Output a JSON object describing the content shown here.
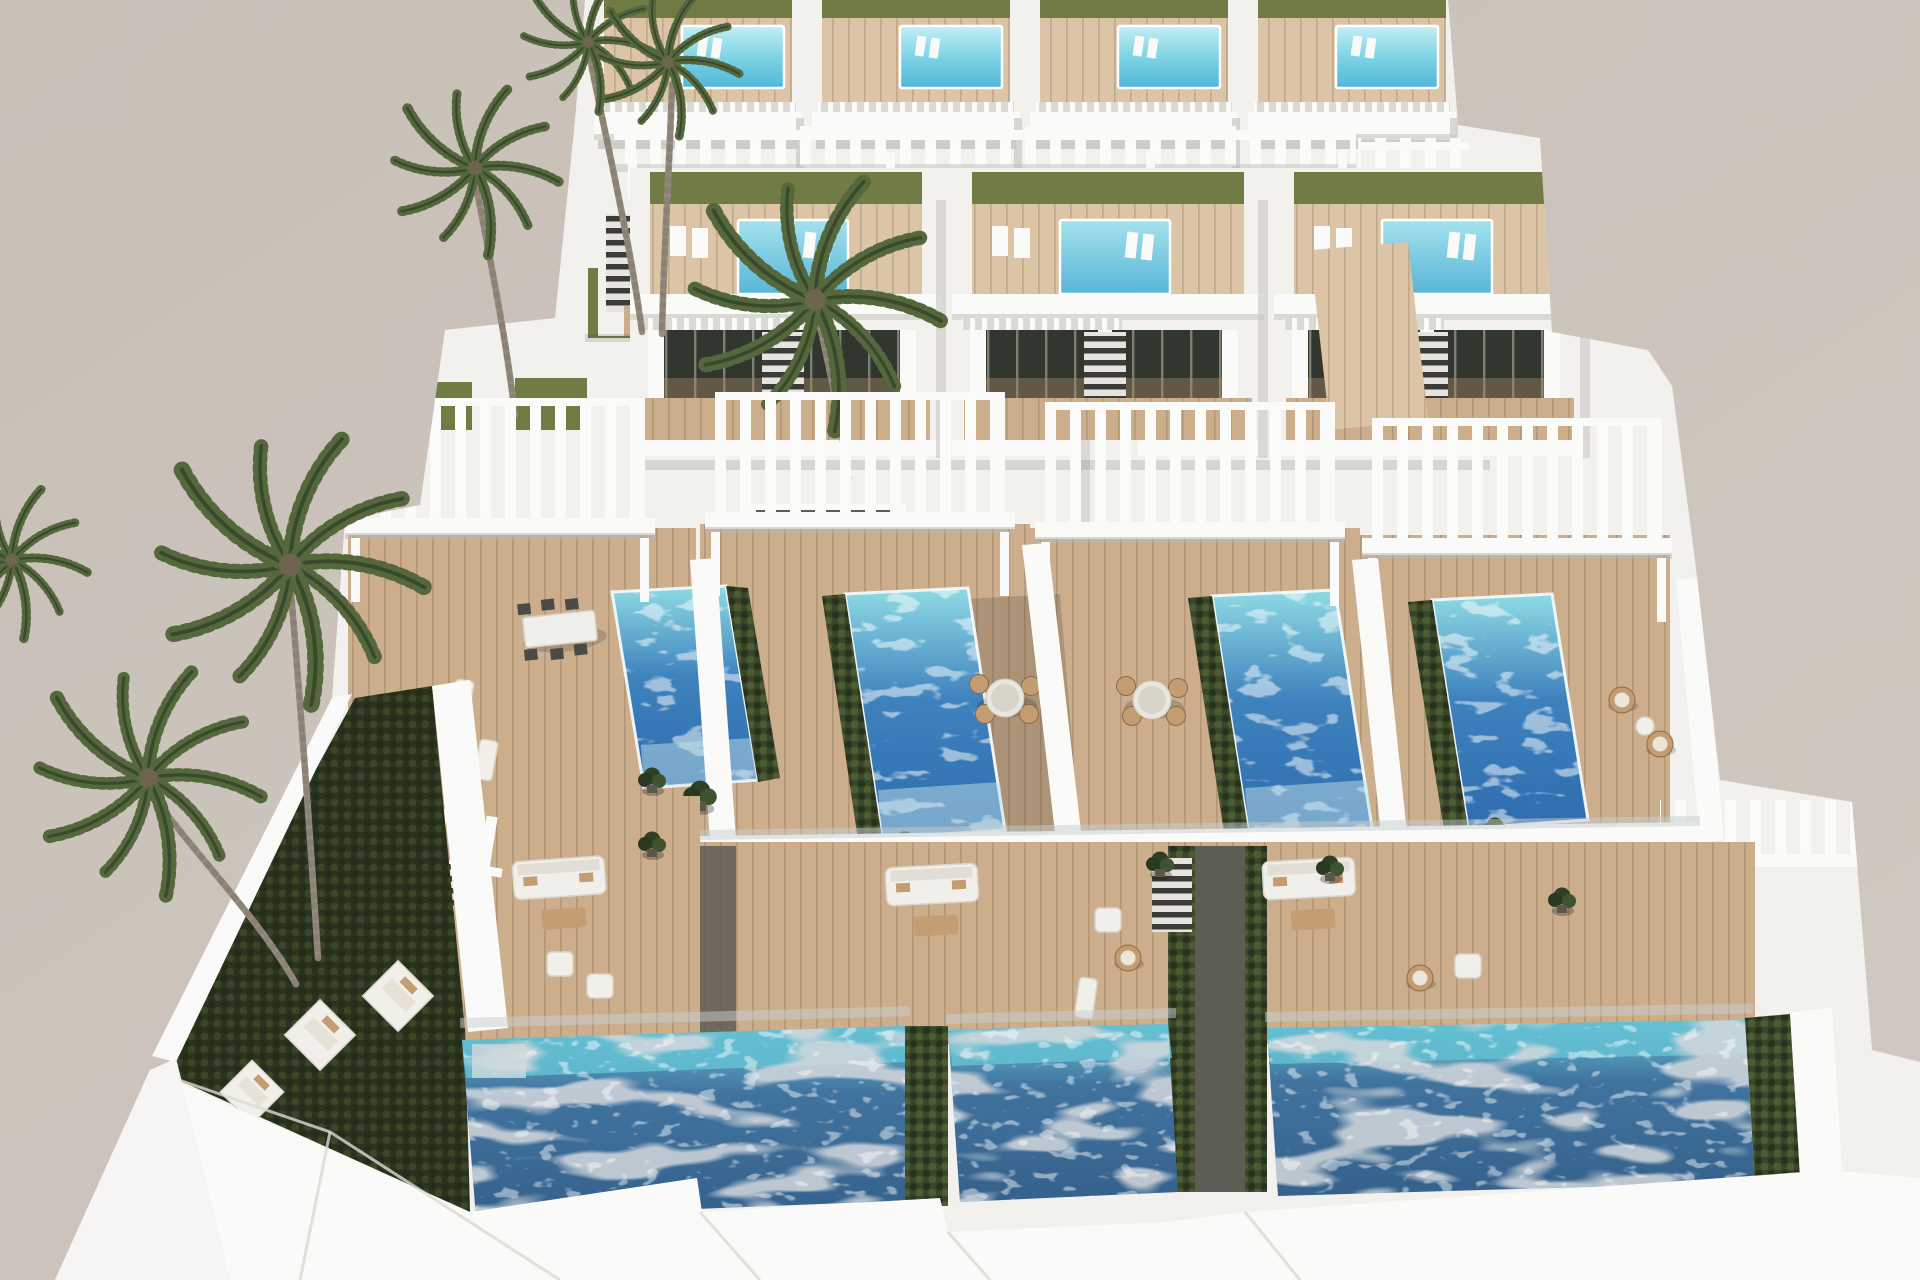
{
  "palette": {
    "sky": "#c8c0b7",
    "sky2": "#d0c9c1",
    "white": "#fafaf8",
    "wall": "#f2f1ee",
    "wall_shade": "#dbd9d4",
    "wall_dark": "#c6c4bf",
    "deck": "#ccae8d",
    "deck_light": "#dcc5a6",
    "deck_dark": "#ab8c6a",
    "deck_walk": "#6e6458",
    "lawn": "#717c45",
    "lawn_dark": "#2a331e",
    "hedge": "#3a4629",
    "glass": "#31362f",
    "walkway": "#5d5c55",
    "wicker": "#c49c72",
    "trunk": "#968d80",
    "trunk_ring": "#837a6c",
    "palm": "#55683d",
    "palm_dark": "#38492c",
    "glassfence": "#c5ced2",
    "pool_roof_hi": "#c4eff4",
    "pool_roof": "#7ed3e4",
    "pool_roof_deep": "#4fb6d8",
    "pool_mid_hi": "#a5e2ec",
    "pool_mid": "#58b5d8",
    "pool_vivid_top": "#8edbe4",
    "pool_vivid": "#3e82bd",
    "pool_vivid_deep": "#2f6cae",
    "pool_ground_top": "#64c0d2",
    "pool_ground": "#41739f",
    "pool_ground_deep": "#35618c",
    "reflect": "#a9b0b6"
  },
  "scene": {
    "type": "3d-architectural-render",
    "subject": "Aerial view of a terraced complex of modern white villas with private pools, wooden sun decks, white pergolas and palm trees against a plain beige sky",
    "lighting": "bright midday sun with soft shadows",
    "camera": "high aerial view looking down stepped terraces",
    "rows": [
      {
        "name": "top-row",
        "villas": 4,
        "features": [
          "small rooftop plunge pool",
          "lawn strip",
          "timber roof deck",
          "slatted white railing",
          "glazed facade",
          "side stair"
        ]
      },
      {
        "name": "middle-row",
        "villas": 3,
        "features": [
          "white slatted pergola band",
          "rooftop pool with in-pool loungers",
          "lawn and timber roof deck",
          "balcony with slatted railing",
          "internal stair"
        ]
      },
      {
        "name": "front-row",
        "villas": 4,
        "features": [
          "large white pergola",
          "elevated garden pool edged with hedges",
          "timber sun deck",
          "outdoor dining set",
          "white privacy walls"
        ]
      }
    ],
    "ground_level": {
      "pools": 3,
      "lawns": "dark green turf with white sun-lounger pads",
      "furniture": [
        "white lounge sofas",
        "armchairs",
        "hanging wicker chairs",
        "sun loungers",
        "potted plants"
      ],
      "details": [
        "glass pool fences",
        "white boundary walls",
        "dark timber walkways",
        "external stairs"
      ]
    },
    "vegetation": {
      "palm_trees": 7,
      "hedges": "dark clipped strips along pools"
    },
    "counts": {
      "villas": 11,
      "rooftop_pools": 7,
      "garden_pools": 4,
      "ground_pools": 3,
      "pergolas": 7,
      "dining_sets": 4,
      "palm_trees": 7
    }
  }
}
